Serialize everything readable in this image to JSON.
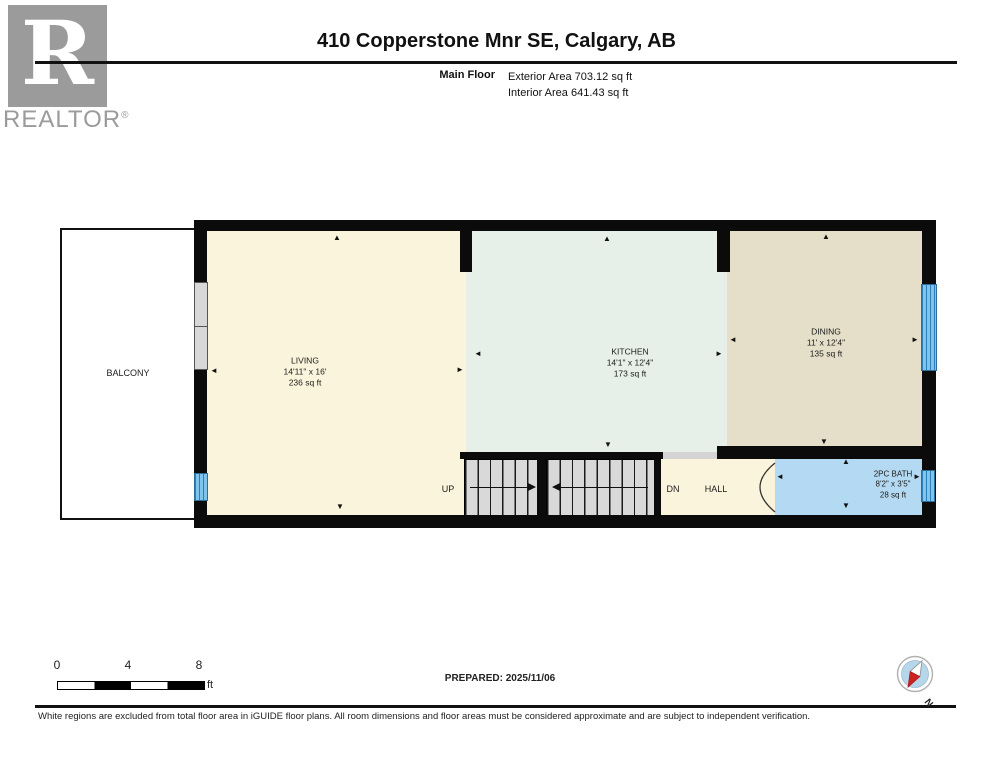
{
  "header": {
    "logo": {
      "letter": "R",
      "brand": "REALTOR",
      "registered": "®"
    },
    "title": "410 Copperstone Mnr SE, Calgary, AB",
    "floor_label": "Main Floor",
    "exterior_area": "Exterior Area 703.12 sq ft",
    "interior_area": "Interior Area 641.43 sq ft"
  },
  "plan": {
    "balcony": {
      "name": "BALCONY"
    },
    "living": {
      "name": "LIVING",
      "dims": "14'11\" x 16'",
      "area": "236 sq ft"
    },
    "kitchen": {
      "name": "KITCHEN",
      "dims": "14'1\" x 12'4\"",
      "area": "173 sq ft"
    },
    "dining": {
      "name": "DINING",
      "dims": "11' x 12'4\"",
      "area": "135 sq ft"
    },
    "bath": {
      "name": "2PC BATH",
      "dims": "8'2\" x 3'5\"",
      "area": "28 sq ft"
    },
    "hall": {
      "name": "HALL"
    },
    "stairs": {
      "up": "UP",
      "down": "DN"
    }
  },
  "icons": {
    "up": "▲",
    "down": "▼",
    "left": "◄",
    "right": "►"
  },
  "footer": {
    "scale": {
      "t0": "0",
      "t4": "4",
      "t8": "8",
      "unit": "ft"
    },
    "prepared": "PREPARED: 2025/11/06",
    "compass_label": "N",
    "disclaimer": "White regions are excluded from total floor area in iGUIDE floor plans. All room dimensions and floor areas must be considered approximate and are subject to independent verification."
  },
  "colors": {
    "living": "#fbf4dc",
    "kitchen": "#e6f0e9",
    "dining": "#e5dec9",
    "bath": "#b4d9f2",
    "window": "#7fc4ec",
    "wall": "#0b0b0b",
    "compassred": "#cc2222"
  }
}
